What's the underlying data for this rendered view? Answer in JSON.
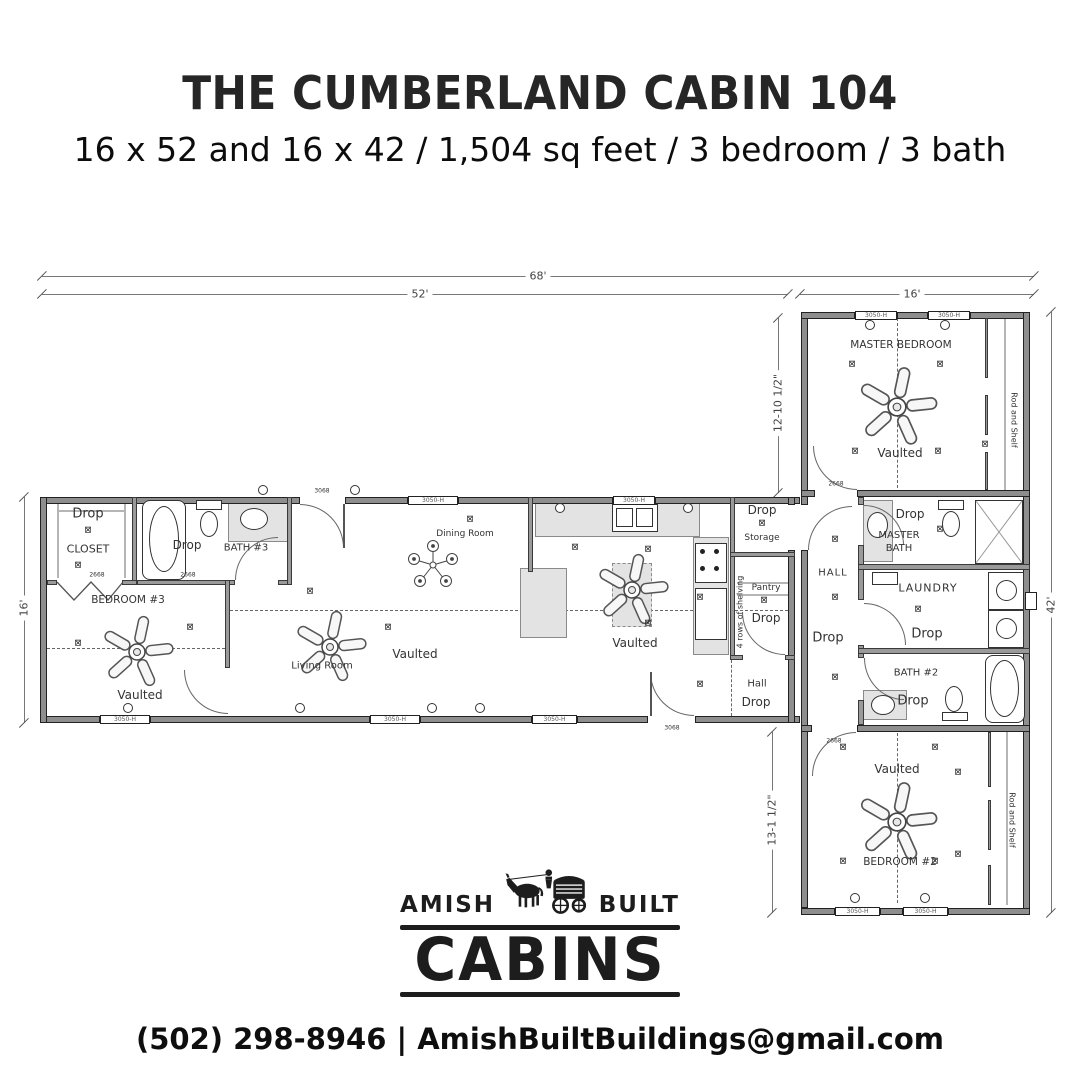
{
  "header": {
    "title": "THE CUMBERLAND CABIN 104",
    "subtitle": "16 x 52 and 16 x 42 / 1,504 sq feet / 3 bedroom / 3 bath"
  },
  "dimensions": {
    "overall_width": "68'",
    "main_width": "52'",
    "wing_width": "16'",
    "main_depth": "16'",
    "wing_upper": "12-10 1/2\"",
    "wing_length": "42'",
    "wing_lower": "13-1 1/2\""
  },
  "rooms": {
    "closet": {
      "name": "CLOSET",
      "note": "Drop"
    },
    "bath3": {
      "name": "BATH #3",
      "note": "Drop"
    },
    "bedroom3": {
      "name": "BEDROOM #3",
      "ceiling": "Vaulted"
    },
    "living": {
      "name": "Living Room",
      "ceiling": "Vaulted"
    },
    "dining": {
      "name": "Dining Room"
    },
    "kitchen": {
      "ceiling": "Vaulted"
    },
    "storage": {
      "name": "Storage",
      "note": "Drop"
    },
    "pantry": {
      "name": "Pantry",
      "note": "Drop",
      "shelving": "4 rows of shelving"
    },
    "hall_main": {
      "name": "Hall",
      "note": "Drop"
    },
    "hall_wing": {
      "name": "HALL",
      "note": "Drop"
    },
    "master_bedroom": {
      "name": "MASTER BEDROOM",
      "ceiling": "Vaulted",
      "closet": "Rod and Shelf"
    },
    "master_bath": {
      "name": "MASTER BATH",
      "note": "Drop"
    },
    "laundry": {
      "name": "LAUNDRY",
      "note": "Drop"
    },
    "bath2": {
      "name": "BATH #2",
      "note": "Drop"
    },
    "bedroom2": {
      "name": "BEDROOM #2",
      "ceiling": "Vaulted",
      "closet": "Rod and Shelf"
    }
  },
  "labels": {
    "window": "3050-H",
    "door": "3068",
    "interior_door": "2668"
  },
  "symbols": {
    "outlet": "⊠"
  },
  "logo": {
    "left": "AMISH",
    "right": "BUILT",
    "name": "CABINS"
  },
  "contact": {
    "phone": "(502) 298-8946",
    "separator": "|",
    "email": "AmishBuiltBuildings@gmail.com"
  }
}
